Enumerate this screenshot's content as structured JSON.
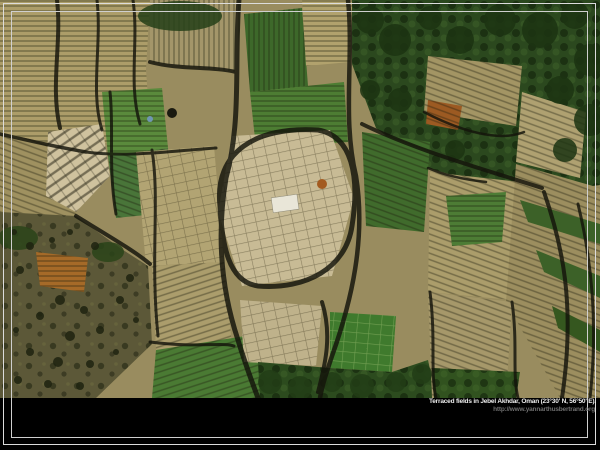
{
  "caption": {
    "title": "Terraced fields in Jebel Akhdar, Oman (23°30' N, 56°50' E).",
    "url": "http://www.yannarthusbertrand.org"
  },
  "frame": {
    "background": "#000000",
    "line_color": "#dcdcdc",
    "caption_title_color": "#ededed",
    "caption_url_color": "#6f6f6f"
  },
  "photo": {
    "subject": "aerial-terraced-fields",
    "palette": {
      "field_tan": "#ab9d6b",
      "field_pale": "#cfc29e",
      "field_green": "#4a7a33",
      "dense_green": "#2b481e",
      "rocky_olive": "#5c5838",
      "shadow_dark": "#14140b",
      "accent_orange": "#9c5a22",
      "white_structure": "#e9e6d8",
      "blue_object": "#7096b3"
    }
  }
}
